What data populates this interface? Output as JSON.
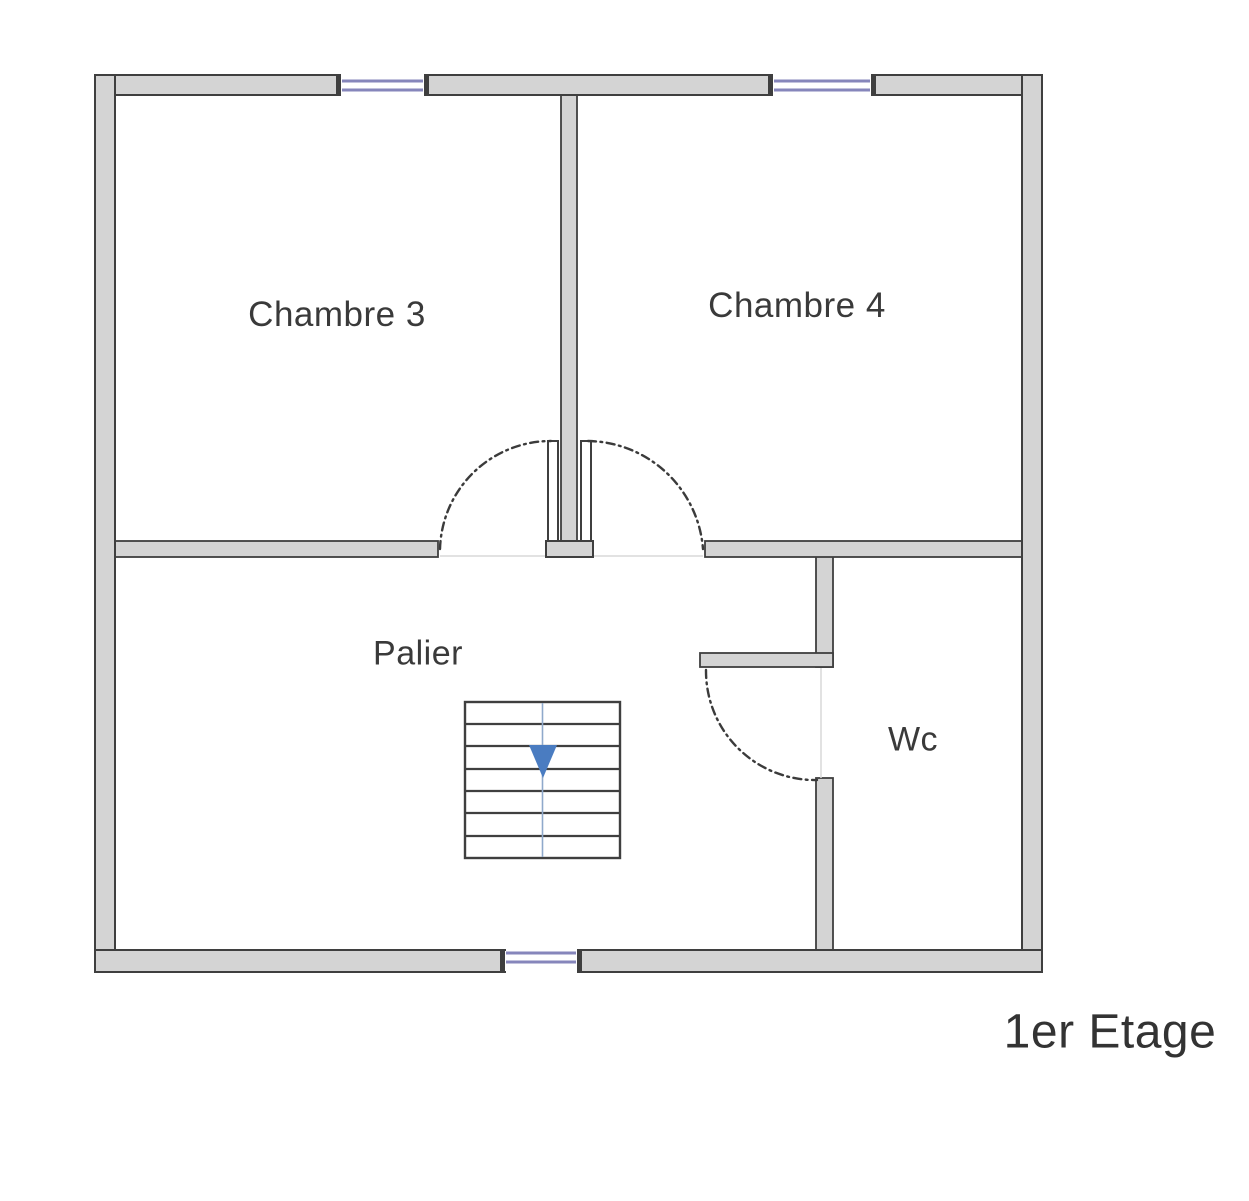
{
  "floorplan": {
    "title": "1er Etage",
    "rooms": {
      "chambre3": "Chambre 3",
      "chambre4": "Chambre 4",
      "palier": "Palier",
      "wc": "Wc"
    },
    "features": {
      "stairs": "stairs-down-arrow",
      "doors": "dash-dot swing arcs",
      "windows": 3
    }
  },
  "colors": {
    "wall_fill": "#d4d4d4",
    "wall_outline": "#3f3f3f",
    "arc": "#3b3b3b",
    "window": "#8686bb",
    "stair_arrow": "#4a7cc1",
    "stair_guide": "#8fa9cb",
    "text": "#3a3a3a",
    "title_color": "#333333"
  }
}
